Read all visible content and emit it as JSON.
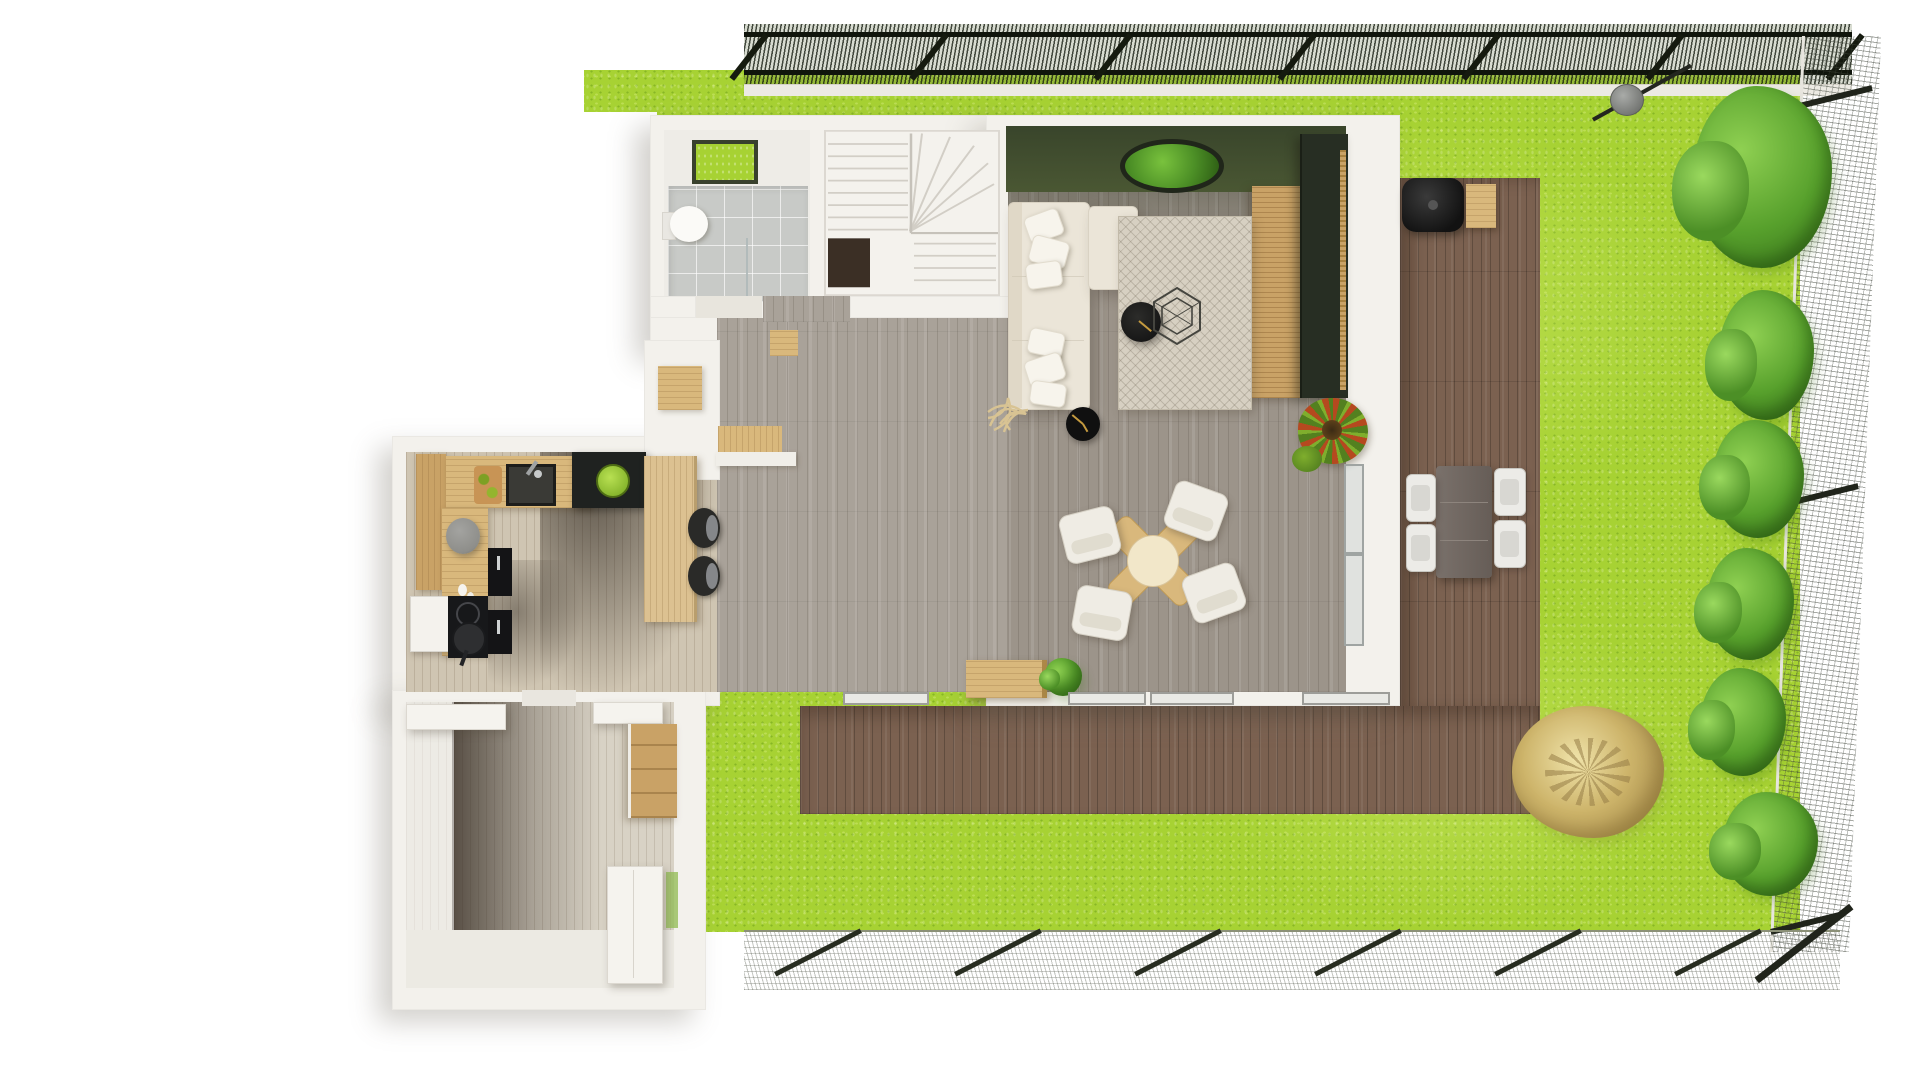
{
  "title": "3D floor plan — top view with garden",
  "colors": {
    "bg": "#ffffff",
    "wall": "#f3f1ec",
    "wall-shade": "#dedacf",
    "grass": "#a7d233",
    "grass-dark": "#7fae22",
    "floor-living": "#9c948a",
    "floor-living-light": "#a9a299",
    "floor-kitchen": "#cfc5b2",
    "floor-hall": "#d8d2c5",
    "deck": "#7b6150",
    "green-wall": "#424f2e",
    "tile": "#c8cac7",
    "wood": "#d9b87c",
    "wood-dark": "#c9a266",
    "ink": "#1b1c1a",
    "sofa": "#ebe5d8",
    "rug": "#d7d0c2",
    "moss": "#4c8f26",
    "bush": "#57a02c",
    "tan-bush": "#cdb46a",
    "fence-dark": "#2a3320",
    "accent-gold": "#c49a3f"
  },
  "scene": {
    "garden": {
      "lawn": "bright-green-grass",
      "fences": [
        "top-dark-mesh-fence",
        "right-wire-mesh-fence",
        "bottom-wire-mesh-fence"
      ],
      "green_bushes_along_right_fence": 6,
      "dry_tan_shrub": 1,
      "folded_parasol": "gray-disc-with-pole",
      "terrace": "l-shaped-brown-wood-deck",
      "outdoor_dining": {
        "table": "dark-rect",
        "white_chairs": 4
      },
      "grill": "black-barbecue-with-wood-side-table"
    },
    "rooms": [
      {
        "name": "bathroom",
        "items": [
          "toilet",
          "walk-in-shower-tile",
          "skylight-grass-window",
          "glass-divider",
          "door-threshold",
          "wood-mat"
        ]
      },
      {
        "name": "staircase",
        "items": [
          "winder-stairs",
          "stairwell-void"
        ]
      },
      {
        "name": "living-room",
        "items": [
          "green-accent-wall",
          "moss-circle-decor",
          "corner-sofa",
          "throw-pillows-6",
          "patterned-rug",
          "black-round-coffee-table",
          "wire-hexagon-table",
          "floor-clock",
          "tv-wall-unit-dark",
          "wood-slat-panel",
          "red-green-plant",
          "twig-decor",
          "wood-bench-at-window",
          "green-plant-at-window"
        ]
      },
      {
        "name": "dining-area",
        "items": [
          "cross-base-round-table",
          "white-chairs-4"
        ]
      },
      {
        "name": "kitchen",
        "items": [
          "pantry-column",
          "l-counter",
          "cutting-board",
          "black-sink",
          "faucet",
          "black-island",
          "green-fruit-bowl",
          "gray-stool",
          "cooktop",
          "frying-pan",
          "white-fridge",
          "black-cabinet-fronts",
          "bar-table",
          "dark-bar-stools-2",
          "window-seat-bench"
        ]
      },
      {
        "name": "entry-hall",
        "items": [
          "white-console-shelf",
          "white-wall-shelf",
          "wood-wall-cabinet",
          "white-wardrobe",
          "glass-door-sliver"
        ]
      }
    ]
  }
}
